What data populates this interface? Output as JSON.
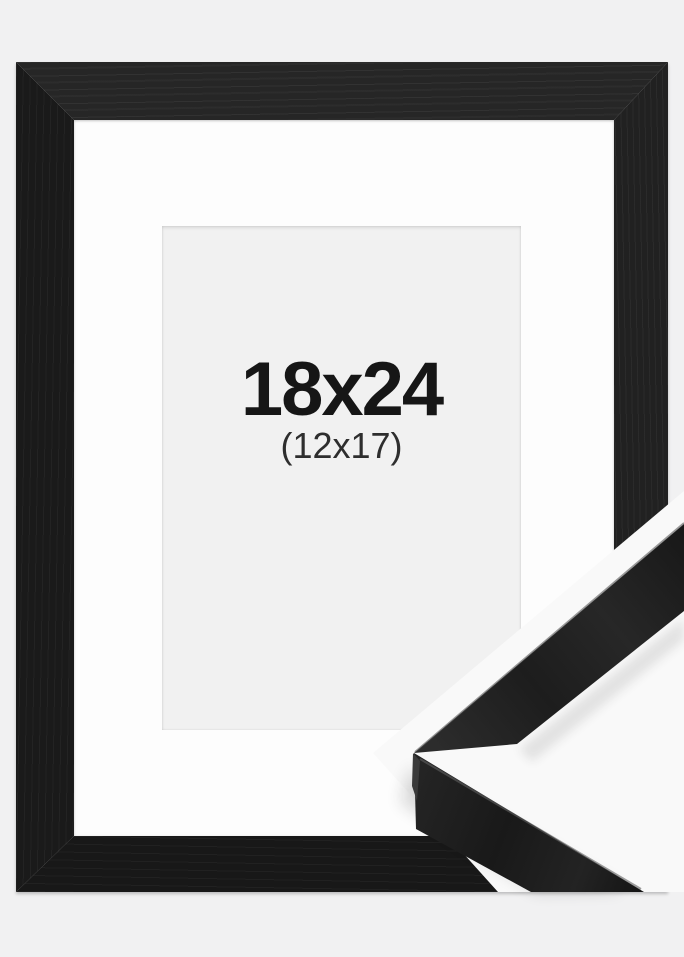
{
  "product": {
    "frame_size_label": "18x24",
    "picture_size_label": "(12x17)"
  },
  "colors": {
    "page_background": "#f1f1f2",
    "frame_black": "#1e1e1e",
    "mat_white": "#fdfdfd",
    "opening_gray": "#f1f1f1",
    "detail_inset_white": "#f9f9f9",
    "label_primary_text": "#161616",
    "label_secondary_text": "#2e2e2e"
  }
}
